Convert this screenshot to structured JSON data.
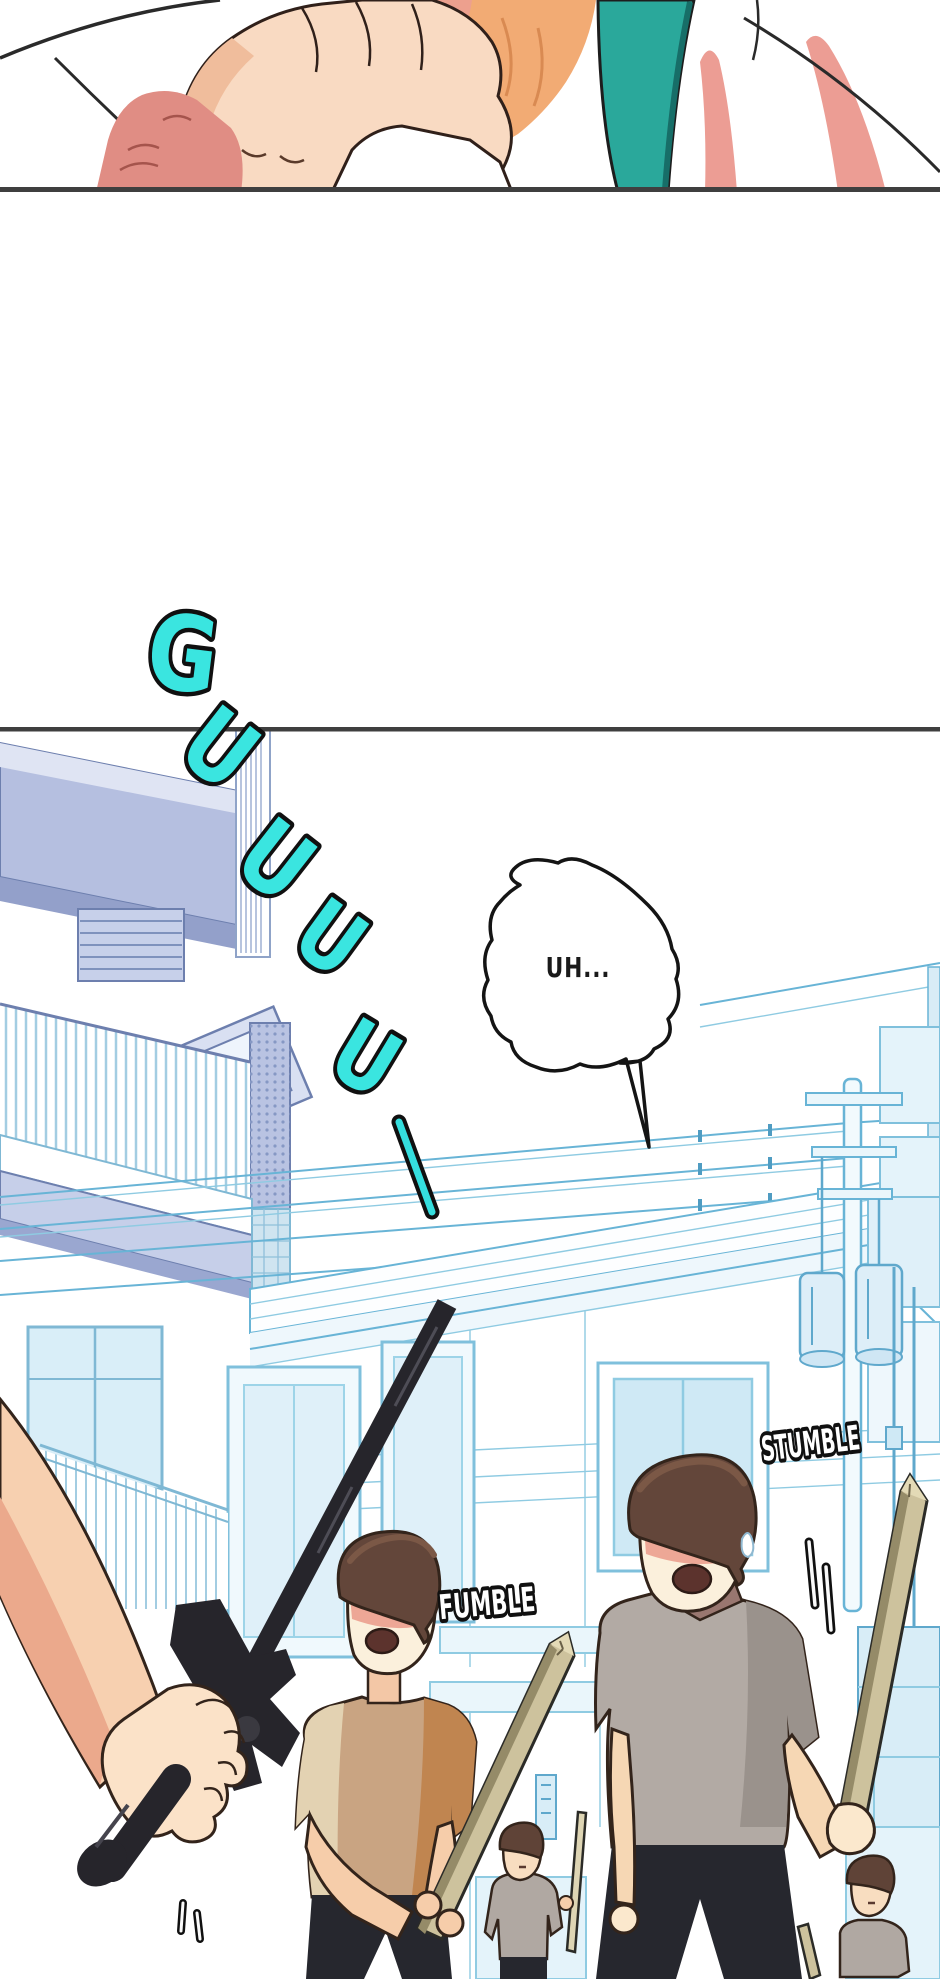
{
  "page": {
    "kind": "webtoon comic page",
    "background": "#ffffff",
    "panel_count": 2
  },
  "panel_top": {
    "description": "close-up: hand pressed against neck, teal strap over white shirt"
  },
  "sfx_guuu": {
    "letters": [
      "G",
      "U",
      "U",
      "U",
      "U"
    ],
    "trail": "—",
    "fill": "#3ae5e0",
    "outline": "#101010"
  },
  "speech_bubble": {
    "text": "UH...",
    "text_color": "#1a1a1a",
    "fill": "#ffffff",
    "stroke": "#141414"
  },
  "sfx_fumble": {
    "text": "FUMBLE",
    "fill": "#ffffff",
    "outline": "#101010"
  },
  "sfx_stumble": {
    "text": "STUMBLE",
    "fill": "#ffffff",
    "outline": "#101010"
  },
  "palette": {
    "lineart_blue": "#68b4d6",
    "lineart_blue_light": "#c8e6f4",
    "periwinkle": "#b5bfe0",
    "teal_strap": "#2aa89b",
    "skin": "#f6cfae",
    "skin_shadow": "#eba98c",
    "pink_shadow": "#ec9d94",
    "hair_brown": "#63463a",
    "shirt_tan": "#c9a482",
    "shirt_gray": "#b2aaa4",
    "collar_mauve": "#997770",
    "pants_dark": "#26272e",
    "stick_wood": "#cdc29d",
    "sword_black": "#26252b",
    "panel_border": "#3f3f3f"
  }
}
